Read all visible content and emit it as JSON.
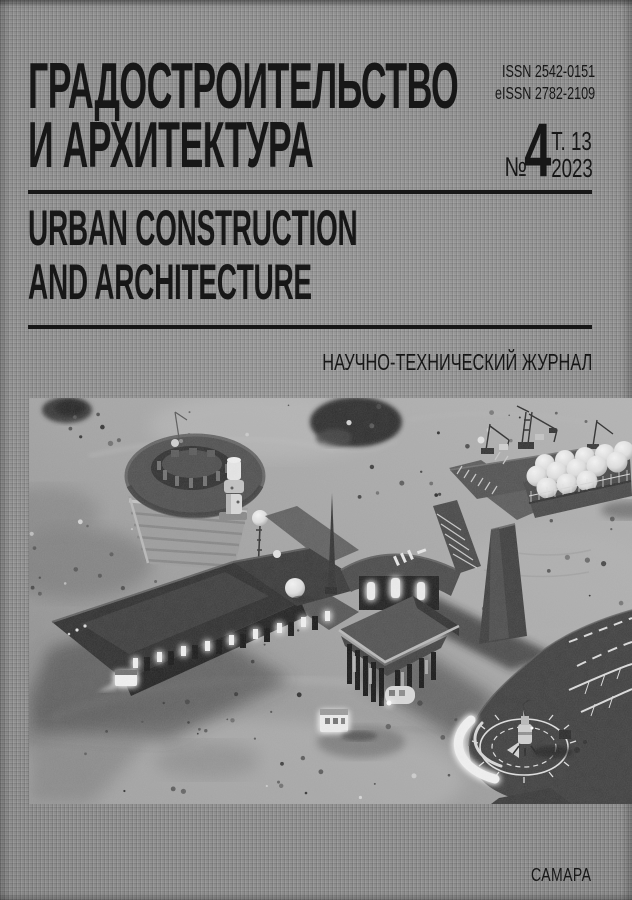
{
  "journal": {
    "title_ru": [
      "ГРАДОСТРОИТЕЛЬСТВО",
      "И АРХИТЕКТУРА"
    ],
    "title_en": [
      "URBAN CONSTRUCTION",
      "AND ARCHITECTURE"
    ],
    "issn_label": "ISSN 2542-0151",
    "eissn_label": "eISSN 2782-2109",
    "issue_mark": "№",
    "issue_number": "4",
    "volume": "Т. 13",
    "year": "2023",
    "subtitle": "НАУЧНО-ТЕХНИЧЕСКИЙ ЖУРНАЛ",
    "city": "САМАРА"
  },
  "colors": {
    "ink": "#171717",
    "cover": "#8f8f8f"
  }
}
